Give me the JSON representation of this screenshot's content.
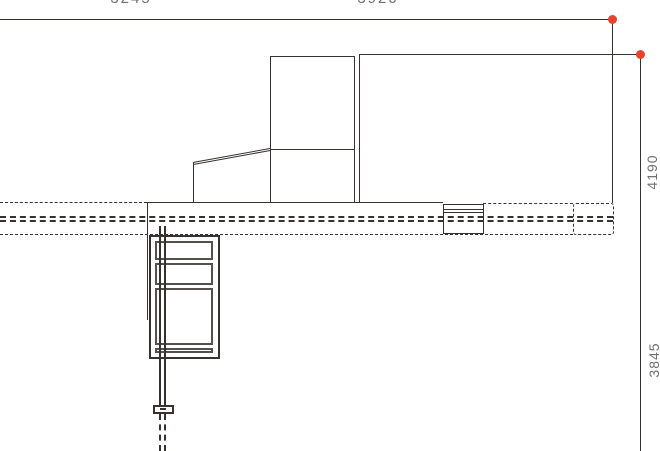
{
  "colors": {
    "background": "#ffffff",
    "line": "#37322d",
    "marker": "#e8422d",
    "dim_text": "#6f6f6f"
  },
  "dimensions": {
    "top": [
      {
        "label": "3245"
      },
      {
        "label": "3920"
      }
    ],
    "right": [
      {
        "label": "4190"
      },
      {
        "label": "3845"
      }
    ]
  }
}
